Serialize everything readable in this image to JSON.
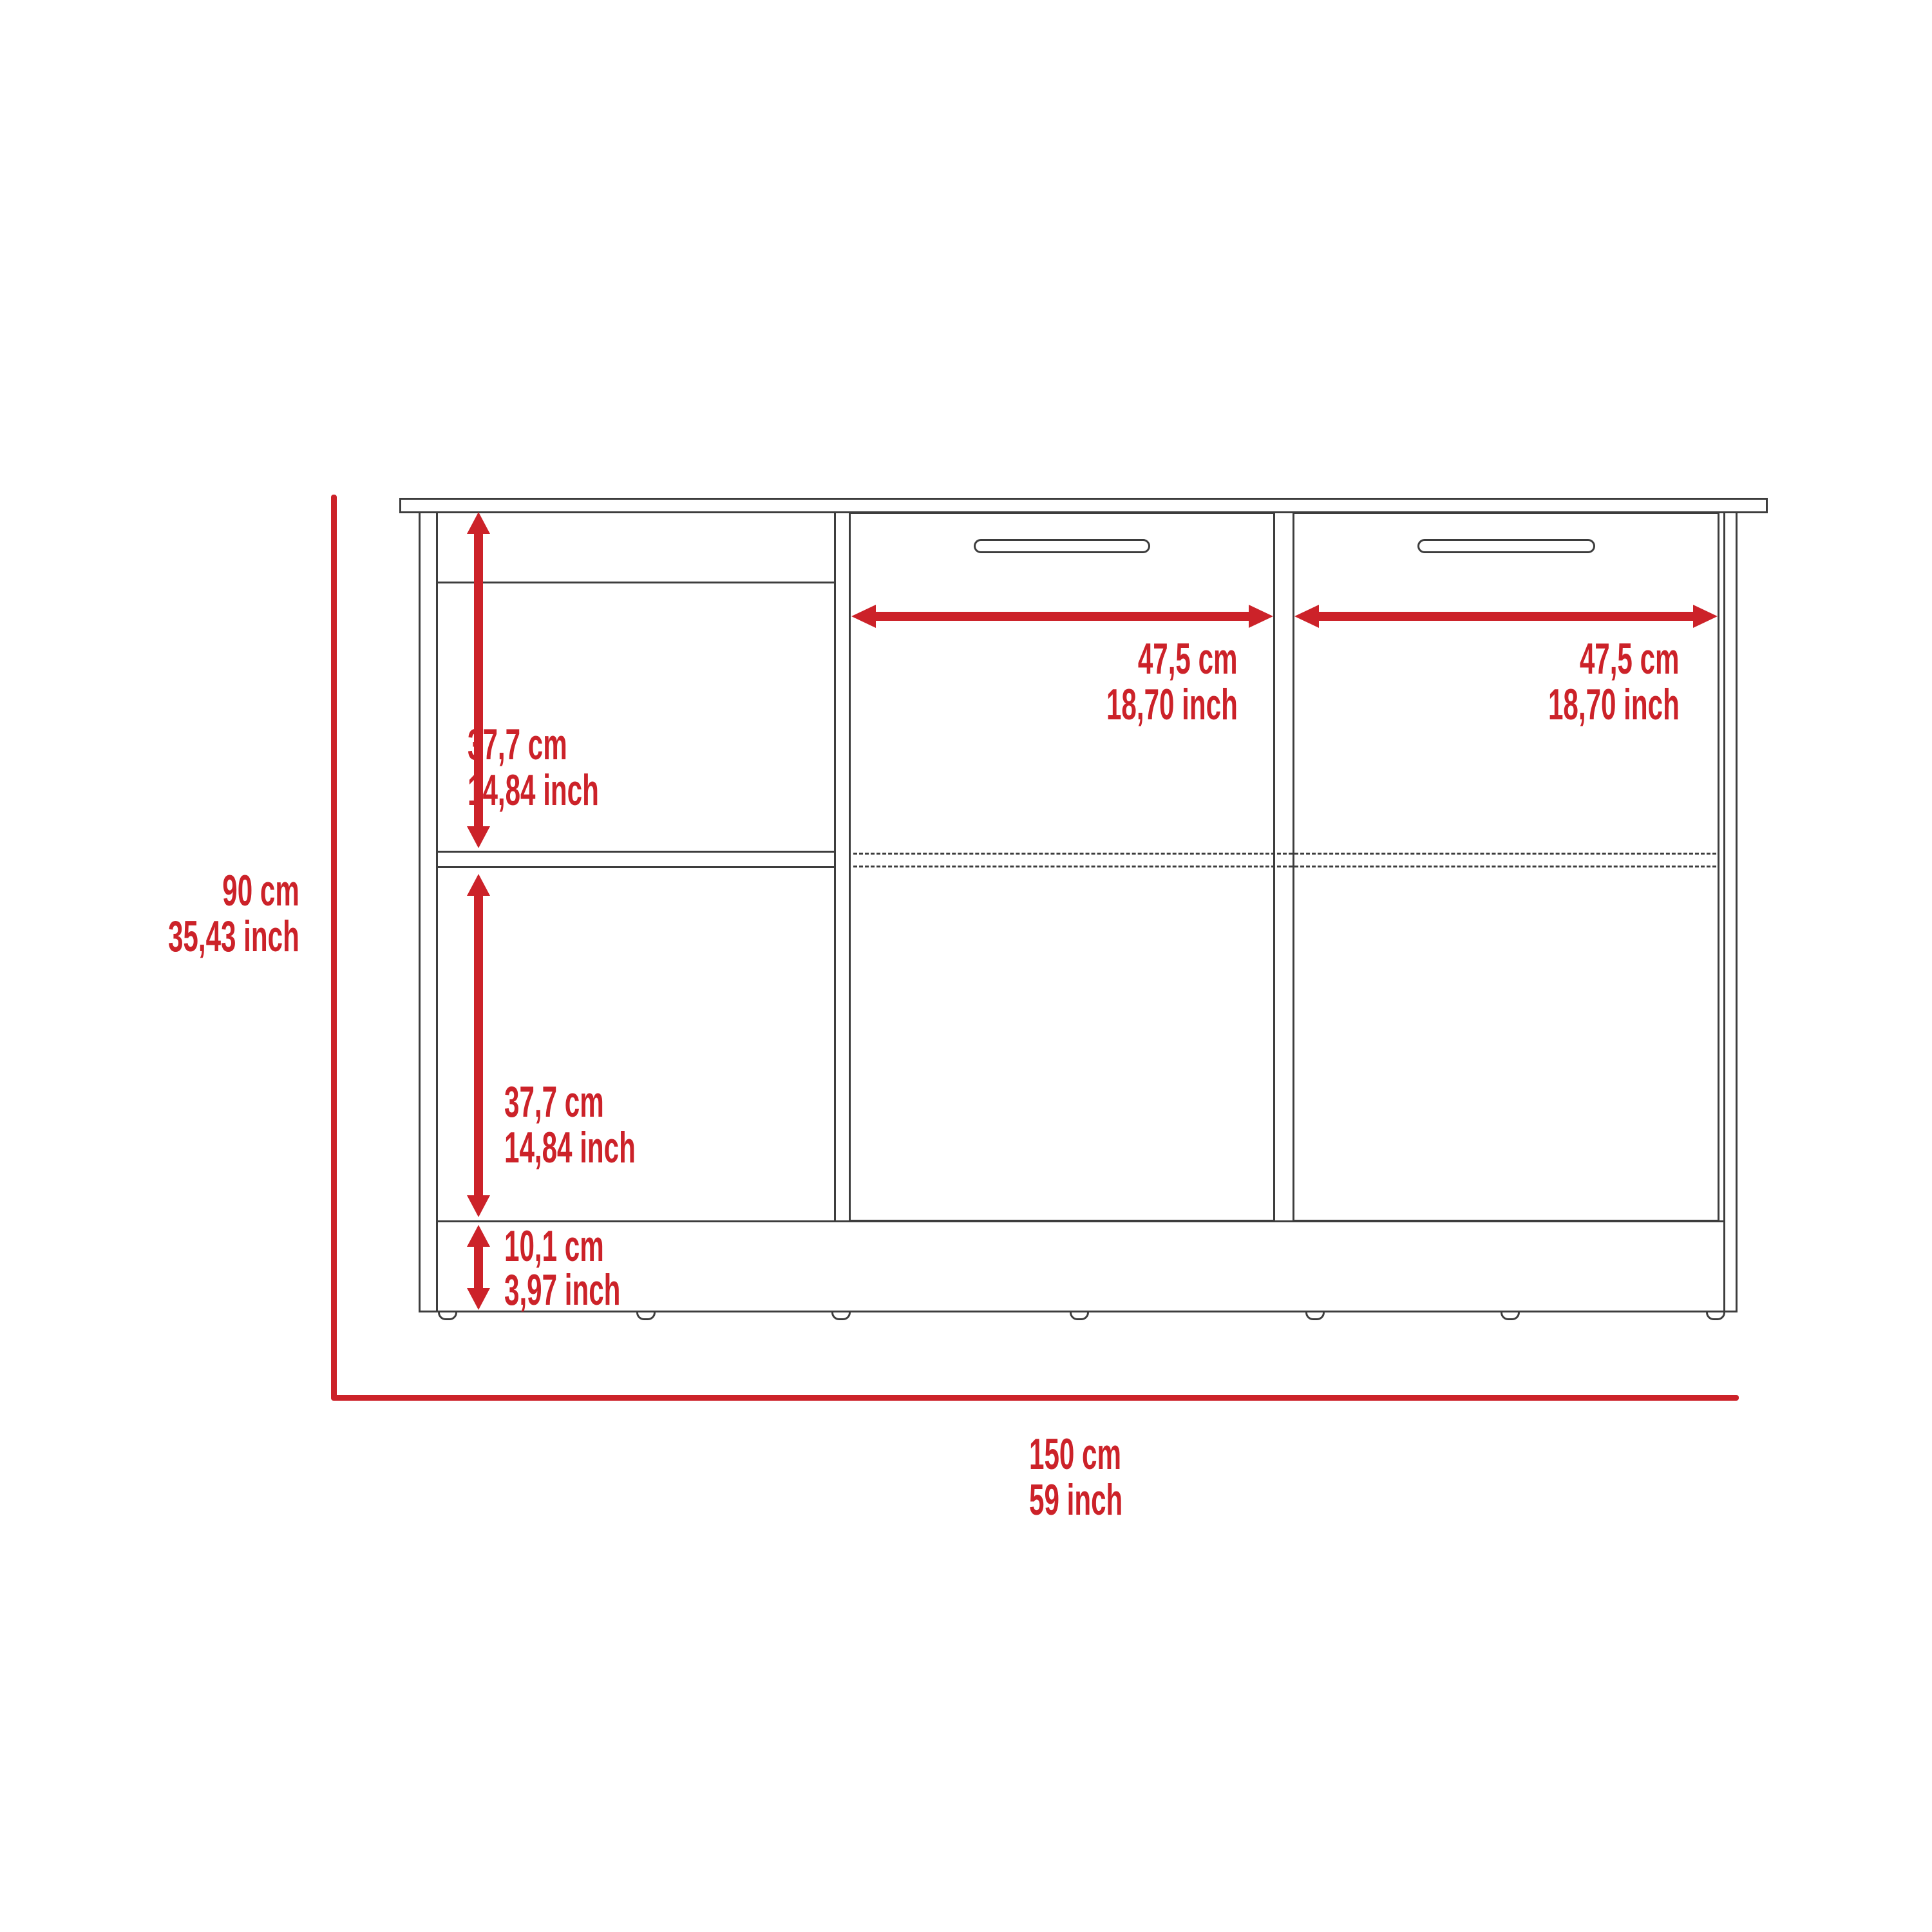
{
  "colors": {
    "dimension_red": "#cc2229",
    "drawing_line": "#3d3d3d",
    "background": "#ffffff"
  },
  "diagram": {
    "type": "furniture-dimension-drawing",
    "subject": "two-door base cabinet with open side shelves, front elevation",
    "dimensions": {
      "total_height": {
        "cm": "90 cm",
        "inch": "35,43 inch"
      },
      "upper_shelf_space": {
        "cm": "37,7 cm",
        "inch": "14,84 inch"
      },
      "lower_shelf_space": {
        "cm": "37,7 cm",
        "inch": "14,84 inch"
      },
      "base_height": {
        "cm": "10,1 cm",
        "inch": "3,97 inch"
      },
      "left_door_width": {
        "cm": "47,5 cm",
        "inch": "18,70 inch"
      },
      "right_door_width": {
        "cm": "47,5 cm",
        "inch": "18,70 inch"
      },
      "total_width": {
        "cm": "150 cm",
        "inch": "59 inch"
      }
    }
  }
}
